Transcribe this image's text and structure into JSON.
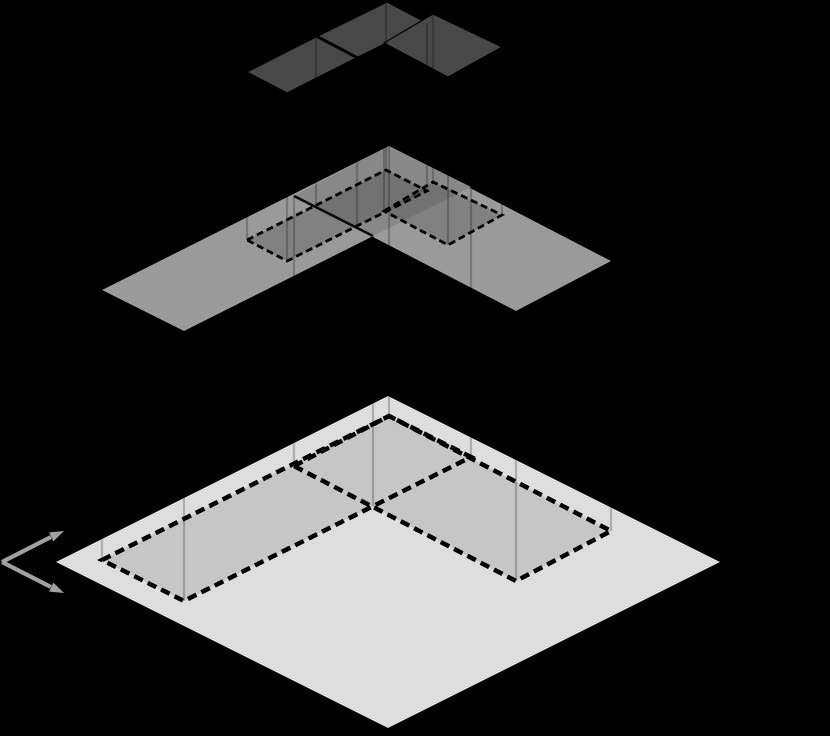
{
  "canvas": {
    "width": 830,
    "height": 736,
    "background": "#000000"
  },
  "colors": {
    "background": "#000000",
    "coarse_level_fill": "#484848",
    "coarse_level_edge": "#000000",
    "mid_level_fill": "#9a9a9a",
    "mid_overlap_shade": "rgba(0,0,0,0.115)",
    "mid_dashed_region_shade": "rgba(0,0,0,0.16)",
    "fine_level_fill": "#dedede",
    "fine_dashed_region_fill": "#c6c6c6",
    "dashed_line": "#000000",
    "solid_seam_line": "#0a0a0a",
    "vertical_connector": "rgba(0,0,0,0.22)",
    "axis_arrow": "#a0a0a0"
  },
  "figure": {
    "kind": "isometric-grid-hierarchy-diagram",
    "levels": [
      {
        "name": "top-coarse-patch",
        "role": "coarsest level, L-shaped patch of dark cells"
      },
      {
        "name": "middle-refined-patch",
        "role": "intermediate level, L-shaped plane with dashed footprints of top cells"
      },
      {
        "name": "bottom-base-plane",
        "role": "finest base plane with dashed footprint of middle level"
      }
    ],
    "polygons": [
      {
        "name": "bottom-base-diamond",
        "points": "56,562 388,396 720,562 388,728",
        "fill": "#dedede"
      },
      {
        "name": "bottom-footprint-left-arm",
        "points": "102,560 389,416 471,457 184,601",
        "fill": "#c6c6c6"
      },
      {
        "name": "bottom-footprint-right-arm",
        "points": "294,466 389,416 611,531 516,581",
        "fill": "#c6c6c6"
      },
      {
        "name": "middle-plane-left-strip",
        "points": "102,290 389,146 471,187 184,331",
        "fill": "#9a9a9a"
      },
      {
        "name": "middle-plane-right-strip",
        "points": "294,196 389,146 611,261 516,311",
        "fill": "#9a9a9a"
      },
      {
        "name": "middle-strip-overlap-shade",
        "points": "294,196 389,146 471,187 373,236",
        "fill": "rgba(0,0,0,0.115)"
      },
      {
        "name": "middle-footprint-left-shade",
        "points": "247,240 386,170 427,191 287,261",
        "fill": "rgba(0,0,0,0.16)"
      },
      {
        "name": "middle-footprint-right-shade",
        "points": "384,211 433,182 502,215 448,245",
        "fill": "rgba(0,0,0,0.16)"
      },
      {
        "name": "top-coarse-cell-1",
        "points": "247,72 316,37 356,58 287,93",
        "fill": "#484848",
        "stroke": "#000000",
        "strokeWidth": 1.2
      },
      {
        "name": "top-coarse-cell-2",
        "points": "318,36 387,2 427,23 358,57",
        "fill": "#484848",
        "stroke": "#000000",
        "strokeWidth": 1.2
      },
      {
        "name": "top-coarse-cell-3",
        "points": "384,43 433,14 502,47 448,77",
        "fill": "#484848",
        "stroke": "#000000",
        "strokeWidth": 1.2
      }
    ],
    "vertical_connectors": {
      "stroke": "rgba(0,0,0,0.22)",
      "width": 2.2,
      "lines": [
        {
          "name": "connector-top-cell1-w",
          "x": 247,
          "y1": 72,
          "y2": 240
        },
        {
          "name": "connector-top-cell1-s",
          "x": 287,
          "y1": 93,
          "y2": 261
        },
        {
          "name": "connector-top-cell1-n",
          "x": 316,
          "y1": 37,
          "y2": 205
        },
        {
          "name": "connector-top-cell1-e",
          "x": 357,
          "y1": 58,
          "y2": 226
        },
        {
          "name": "connector-top-cell2-n",
          "x": 386,
          "y1": 2,
          "y2": 170
        },
        {
          "name": "connector-top-cell2-e",
          "x": 427,
          "y1": 23,
          "y2": 191
        },
        {
          "name": "connector-top-cell3-w",
          "x": 384,
          "y1": 43,
          "y2": 211
        },
        {
          "name": "connector-top-cell3-n",
          "x": 433,
          "y1": 14,
          "y2": 182
        },
        {
          "name": "connector-top-cell3-e",
          "x": 502,
          "y1": 47,
          "y2": 215
        },
        {
          "name": "connector-top-cell3-s",
          "x": 448,
          "y1": 77,
          "y2": 245
        },
        {
          "name": "connector-mid-w",
          "x": 102,
          "y1": 290,
          "y2": 560
        },
        {
          "name": "connector-mid-sw",
          "x": 184,
          "y1": 331,
          "y2": 601
        },
        {
          "name": "connector-mid-a",
          "x": 294,
          "y1": 196,
          "y2": 466
        },
        {
          "name": "connector-mid-valley",
          "x": 373,
          "y1": 236,
          "y2": 506
        },
        {
          "name": "connector-mid-n",
          "x": 389,
          "y1": 146,
          "y2": 416
        },
        {
          "name": "connector-mid-ne",
          "x": 471,
          "y1": 187,
          "y2": 457
        },
        {
          "name": "connector-mid-e",
          "x": 611,
          "y1": 261,
          "y2": 531
        },
        {
          "name": "connector-mid-se",
          "x": 516,
          "y1": 311,
          "y2": 581
        }
      ]
    },
    "dashed_outlines": [
      {
        "name": "bottom-dashed-left-arm",
        "points": "102,560 389,416 471,457 184,601",
        "stroke": "#000000",
        "width": 4.5,
        "dash": "9.5 5.5"
      },
      {
        "name": "bottom-dashed-right-arm",
        "points": "294,466 389,416 611,531 516,581",
        "stroke": "#000000",
        "width": 4.5,
        "dash": "9.5 5.5"
      },
      {
        "name": "middle-dashed-left",
        "points": "247,240 386,170 427,191 287,261",
        "stroke": "#000000",
        "width": 2.8,
        "dash": "7 4"
      },
      {
        "name": "middle-dashed-right",
        "points": "384,211 433,182 502,215 448,245",
        "stroke": "#000000",
        "width": 2.8,
        "dash": "7 4"
      }
    ],
    "solid_lines": [
      {
        "name": "middle-strip-seam-line",
        "x1": 294,
        "y1": 196,
        "x2": 373,
        "y2": 236,
        "stroke": "#0a0a0a",
        "width": 2.5
      }
    ],
    "axes_indicator": {
      "color": "#a0a0a0",
      "line_width": 4.2,
      "lines": [
        {
          "name": "axis-arrow-shaft-up",
          "x1": 2,
          "y1": 562,
          "x2": 51,
          "y2": 537
        },
        {
          "name": "axis-arrow-shaft-down",
          "x1": 2,
          "y1": 562,
          "x2": 51,
          "y2": 587
        }
      ],
      "heads": [
        {
          "name": "axis-arrow-head-up",
          "points": "64,531 53.4,541.4 49.2,532.4"
        },
        {
          "name": "axis-arrow-head-down",
          "points": "64,593 53.4,582.6 49.2,591.6"
        }
      ]
    }
  }
}
